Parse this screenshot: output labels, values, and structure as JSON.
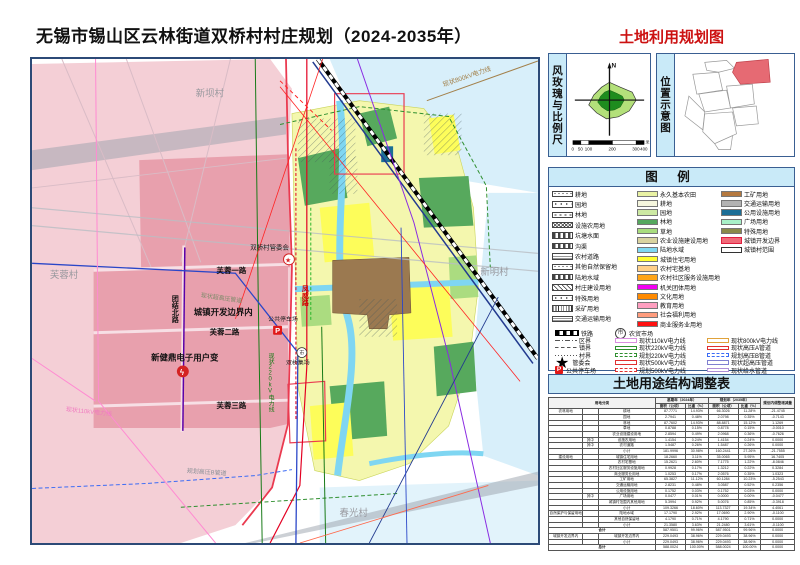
{
  "page": {
    "title": "无锡市锡山区云林街道双桥村村庄规划（2024-2035年）",
    "map_title": "土地利用规划图"
  },
  "panels": {
    "windrose_label": "风玫瑰与比例尺",
    "location_label": "位置示意图",
    "legend_title": "图  例",
    "table_title": "土地用途结构调整表",
    "north": "N",
    "scale_ticks": [
      "0",
      "50",
      "100",
      "200",
      "300",
      "400"
    ],
    "scale_unit": "米"
  },
  "legend": {
    "pattern_items": [
      {
        "label": "耕地",
        "type": "dots-a"
      },
      {
        "label": "园地",
        "type": "dots-b"
      },
      {
        "label": "林地",
        "type": "dots-c"
      },
      {
        "label": "设施农用地",
        "type": "zigzag"
      },
      {
        "label": "坑塘水面",
        "type": "dash"
      },
      {
        "label": "沟渠",
        "type": "dash"
      },
      {
        "label": "农村道路",
        "type": "hlines"
      },
      {
        "label": "其他自然保留地",
        "type": "dots-a"
      },
      {
        "label": "陆地水域",
        "type": "dash"
      },
      {
        "label": "村庄建设用地",
        "type": "hatch"
      },
      {
        "label": "特殊用地",
        "type": "dots-b"
      },
      {
        "label": "采矿用地",
        "type": "vlines"
      },
      {
        "label": "交通运输用地",
        "type": "hlines"
      }
    ],
    "color_items": [
      {
        "label": "永久基本农田",
        "color": "#e9f2a3"
      },
      {
        "label": "耕地",
        "color": "#f5f6de"
      },
      {
        "label": "园地",
        "color": "#cde9a3"
      },
      {
        "label": "林地",
        "color": "#55a85e"
      },
      {
        "label": "草地",
        "color": "#a9dd7e"
      },
      {
        "label": "农业设施建设用地",
        "color": "#d9d3a0"
      },
      {
        "label": "陆地水域",
        "color": "#7fd9f2"
      },
      {
        "label": "城镇住宅用地",
        "color": "#ffff33"
      },
      {
        "label": "农村宅基地",
        "color": "#ffd08a"
      },
      {
        "label": "农村社区服务设施用地",
        "color": "#ffa418"
      },
      {
        "label": "机关团体用地",
        "color": "#f200f2"
      },
      {
        "label": "文化用地",
        "color": "#ff8a00"
      },
      {
        "label": "教育用地",
        "color": "#ff9fc0"
      },
      {
        "label": "社会福利用地",
        "color": "#ff9d7e"
      },
      {
        "label": "商业服务业用地",
        "color": "#ff1111"
      }
    ],
    "misc_items": [
      {
        "label": "工矿用地",
        "color": "#b5793f"
      },
      {
        "label": "交通运输用地",
        "color": "#b3b3b3"
      },
      {
        "label": "公用设施用地",
        "color": "#1c6e96"
      },
      {
        "label": "广场用地",
        "color": "#a8f0c8"
      },
      {
        "label": "特殊用地",
        "color": "#8a8a4a"
      },
      {
        "label": "城镇开发边界",
        "color": "#f06a78",
        "border": "#e02040"
      },
      {
        "label": "城镇村范围",
        "color": "#ffffff",
        "border": "#333333"
      }
    ],
    "sym_left": [
      {
        "label": "铁路",
        "type": "rail"
      },
      {
        "label": "区界",
        "type": "dashdot"
      },
      {
        "label": "镇界",
        "type": "dashed2"
      },
      {
        "label": "村界",
        "type": "dotted"
      },
      {
        "label": "管委会",
        "type": "star",
        "glyph": "★"
      },
      {
        "label": "公共停车场",
        "type": "pmark",
        "glyph": "P"
      }
    ],
    "sym_mid": [
      {
        "label": "农贸市场",
        "type": "market",
        "glyph": "市"
      },
      {
        "label": "现状110kV电力线",
        "type": "tube",
        "color": "#d98fe0"
      },
      {
        "label": "现状220kV电力线",
        "type": "tube",
        "color": "#2e8f2e"
      },
      {
        "label": "规划220kV电力线",
        "type": "tube-d",
        "color": "#2e8f2e"
      },
      {
        "label": "现状500kV电力线",
        "type": "tube",
        "color": "#e03030"
      },
      {
        "label": "规划500kV电力线",
        "type": "tube-d",
        "color": "#e03030"
      }
    ],
    "sym_right": [
      {
        "label": "现状800kV电力线",
        "type": "tube",
        "color": "#e0a23a"
      },
      {
        "label": "现状高压A管道",
        "type": "tube",
        "color": "#e03030"
      },
      {
        "label": "规划高压B管道",
        "type": "tube-d",
        "color": "#3b6bf5"
      },
      {
        "label": "现状超高压管道",
        "type": "tube",
        "color": "#8080d0"
      },
      {
        "label": "现状给水管道",
        "type": "tube",
        "color": "#b08fd8"
      }
    ]
  },
  "map": {
    "labels": {
      "xinba": "新坝村",
      "furong_village": "芙蓉村",
      "xinming": "新明村",
      "chunguang": "春光村",
      "furong1": "芙蓉一路",
      "furong2": "芙蓉二路",
      "furong3": "芙蓉三路",
      "tuanjie": "团结北路",
      "fengwei": "凤威路",
      "boundary_note": "城镇开发边界内",
      "transformer": "新健鼎电子用户变",
      "transformer_glyph": "ϟ",
      "parking": "公共停车场",
      "parking_glyph": "P",
      "committee": "双桥村管委会",
      "committee_glyph": "★",
      "market": "双桥集场",
      "market_glyph": "市",
      "pipe_uhv": "现状超高压管道",
      "line110": "现状110kV电力线",
      "pipeB": "规划高压B管道",
      "line800": "现状800kV电力线",
      "line220": "现状220kV电力线"
    }
  },
  "table": {
    "headers": {
      "cls": "用地分类",
      "base": "基期年（2024年）",
      "plan": "规划年（2035年）",
      "adj": "规划内调整增减量",
      "area": "面积（公顷）",
      "pct": "比重（%）"
    },
    "rows": [
      [
        "农林用地",
        "",
        "耕地",
        "87.7771",
        "14.93%",
        "66.3026",
        "11.28%",
        "-21.4745"
      ],
      [
        "",
        "",
        "园地",
        "2.7941",
        "0.48%",
        "2.0798",
        "0.35%",
        "-0.7143"
      ],
      [
        "",
        "",
        "林地",
        "87.7602",
        "14.93%",
        "88.8871",
        "15.12%",
        "1.1269"
      ],
      [
        "",
        "",
        "草地",
        "0.8788",
        "0.15%",
        "0.8778",
        "0.15%",
        "-0.0010"
      ],
      [
        "",
        "",
        "农业设施建设用地",
        "2.8594",
        "0.49%",
        "2.0968",
        "0.36%",
        "-0.7626"
      ],
      [
        "",
        "其中",
        "设施农用地",
        "1.4154",
        "0.24%",
        "1.4154",
        "0.24%",
        "0.0000"
      ],
      [
        "",
        "其中",
        "农村道路",
        "1.5487",
        "0.26%",
        "1.5487",
        "0.26%",
        "0.0000"
      ],
      [
        "",
        "",
        "小计",
        "181.9996",
        "30.98%",
        "160.2441",
        "27.26%",
        "-21.7555"
      ],
      [
        "建设用地",
        "",
        "城镇住宅用地",
        "18.2660",
        "3.11%",
        "35.0065",
        "5.95%",
        "16.7405"
      ],
      [
        "",
        "",
        "农村宅基地",
        "15.2621",
        "2.60%",
        "7.1775",
        "1.22%",
        "-8.0846"
      ],
      [
        "",
        "",
        "农村社区服务设施用地",
        "0.9928",
        "0.17%",
        "1.3212",
        "0.22%",
        "0.3284"
      ],
      [
        "",
        "",
        "商业服务业用地",
        "1.0253",
        "0.17%",
        "2.0576",
        "0.35%",
        "1.0323"
      ],
      [
        "",
        "",
        "工矿用地",
        "65.3827",
        "11.12%",
        "60.1284",
        "10.23%",
        "-5.2543"
      ],
      [
        "",
        "",
        "交通运输用地",
        "2.8231",
        "0.48%",
        "3.0587",
        "0.52%",
        "0.2356"
      ],
      [
        "",
        "",
        "公用设施用地",
        "0.1752",
        "0.03%",
        "0.1752",
        "0.03%",
        "0.0000"
      ],
      [
        "",
        "其中",
        "广场用地",
        "0.0477",
        "0.01%",
        "0.0000",
        "0.00%",
        "-0.0477"
      ],
      [
        "",
        "",
        "城镇村范围内其他用地",
        "5.3994",
        "0.92%",
        "5.0076",
        "0.85%",
        "-0.3918"
      ],
      [
        "",
        "",
        "小计",
        "109.3266",
        "18.60%",
        "113.7327",
        "19.34%",
        "4.4061"
      ],
      [
        "自然保护与保留用地",
        "",
        "陆地水域",
        "17.1790",
        "2.92%",
        "17.0690",
        "2.90%",
        "-0.1100"
      ],
      [
        "",
        "",
        "其他自然保留地",
        "4.1790",
        "0.71%",
        "4.1790",
        "0.71%",
        "0.0000"
      ],
      [
        "",
        "",
        "小计",
        "21.3580",
        "3.63%",
        "21.2480",
        "3.61%",
        "-0.1100"
      ],
      [
        "合计",
        "587.9501",
        "99.96%",
        "587.9501",
        "99.96%",
        "0.0000"
      ],
      [
        "城镇开发边界内",
        "",
        "城镇开发边界内",
        "229.0493",
        "38.96%",
        "229.0493",
        "38.96%",
        "0.0000"
      ],
      [
        "",
        "",
        "小计",
        "229.0493",
        "38.96%",
        "229.0493",
        "38.96%",
        "0.0000"
      ],
      [
        "总计",
        "588.0024",
        "100.00%",
        "588.0024",
        "100.00%",
        "0.0000"
      ]
    ]
  }
}
